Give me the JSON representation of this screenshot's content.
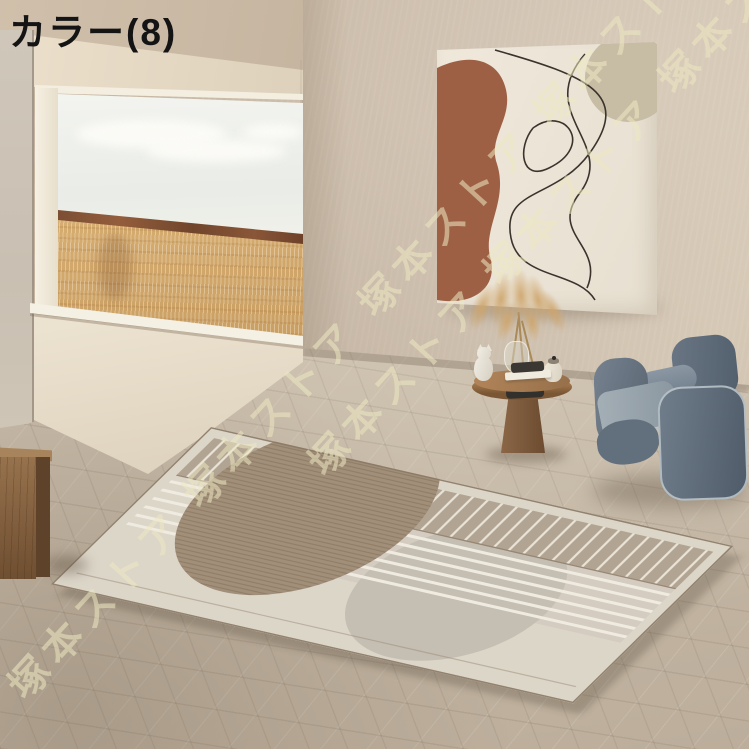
{
  "page": {
    "width": 749,
    "height": 749
  },
  "overlay": {
    "label": "カラー(8)",
    "watermark_text": "塚本ストア",
    "watermark_line": "塚本ストア 塚本ストア 塚本ストア 塚本ストア 塚本ストア"
  },
  "scene": {
    "objects": [
      "beige plaster back wall",
      "ceiling soffit above wall opening",
      "full-width wall opening with view of golden grass field under pale sky",
      "dark reddish horizon band",
      "white window frame and sill",
      "hexagonal stone tile floor",
      "sunlit floor patch below opening",
      "geometric area rug with taupe stripe band, white stripes, brown and gray semicircles",
      "abstract wall art with terracotta shape, beige circle and black line drawing",
      "pampas grass in glass vase",
      "round wooden side table with cat figurine, jar, tray and book",
      "slate blue fabric armchair with light piping",
      "wooden block stool at left edge"
    ],
    "palette": {
      "wall": "#cabbaa",
      "ceiling_soffit": "#e7dcc8",
      "floor": "#c9bcaa",
      "window_sky": "#eef0ea",
      "field_gold": "#d2a96c",
      "horizon_brown": "#7e4e33",
      "sill_white": "#f5f0e4",
      "art_canvas": "#ebe4d6",
      "art_terracotta": "#9d6045",
      "art_circle_beige": "#c7bca4",
      "art_line": "#37322c",
      "rug_base": "#dcd6c9",
      "rug_band_taupe": "#b2a492",
      "rug_stripe_white": "#f0ebe0",
      "rug_brown_semicircle": "#a18f79",
      "rug_gray_semicircle": "#c5bfb3",
      "chair_blue": "#64778b",
      "chair_cushion": "#9aa8b3",
      "chair_piping": "#c6cfd5",
      "table_wood": "#96704a",
      "pampas": "#cfa874",
      "wood_block": "#82613f",
      "watermark": "#ede7c1",
      "label_text": "#141414"
    }
  }
}
